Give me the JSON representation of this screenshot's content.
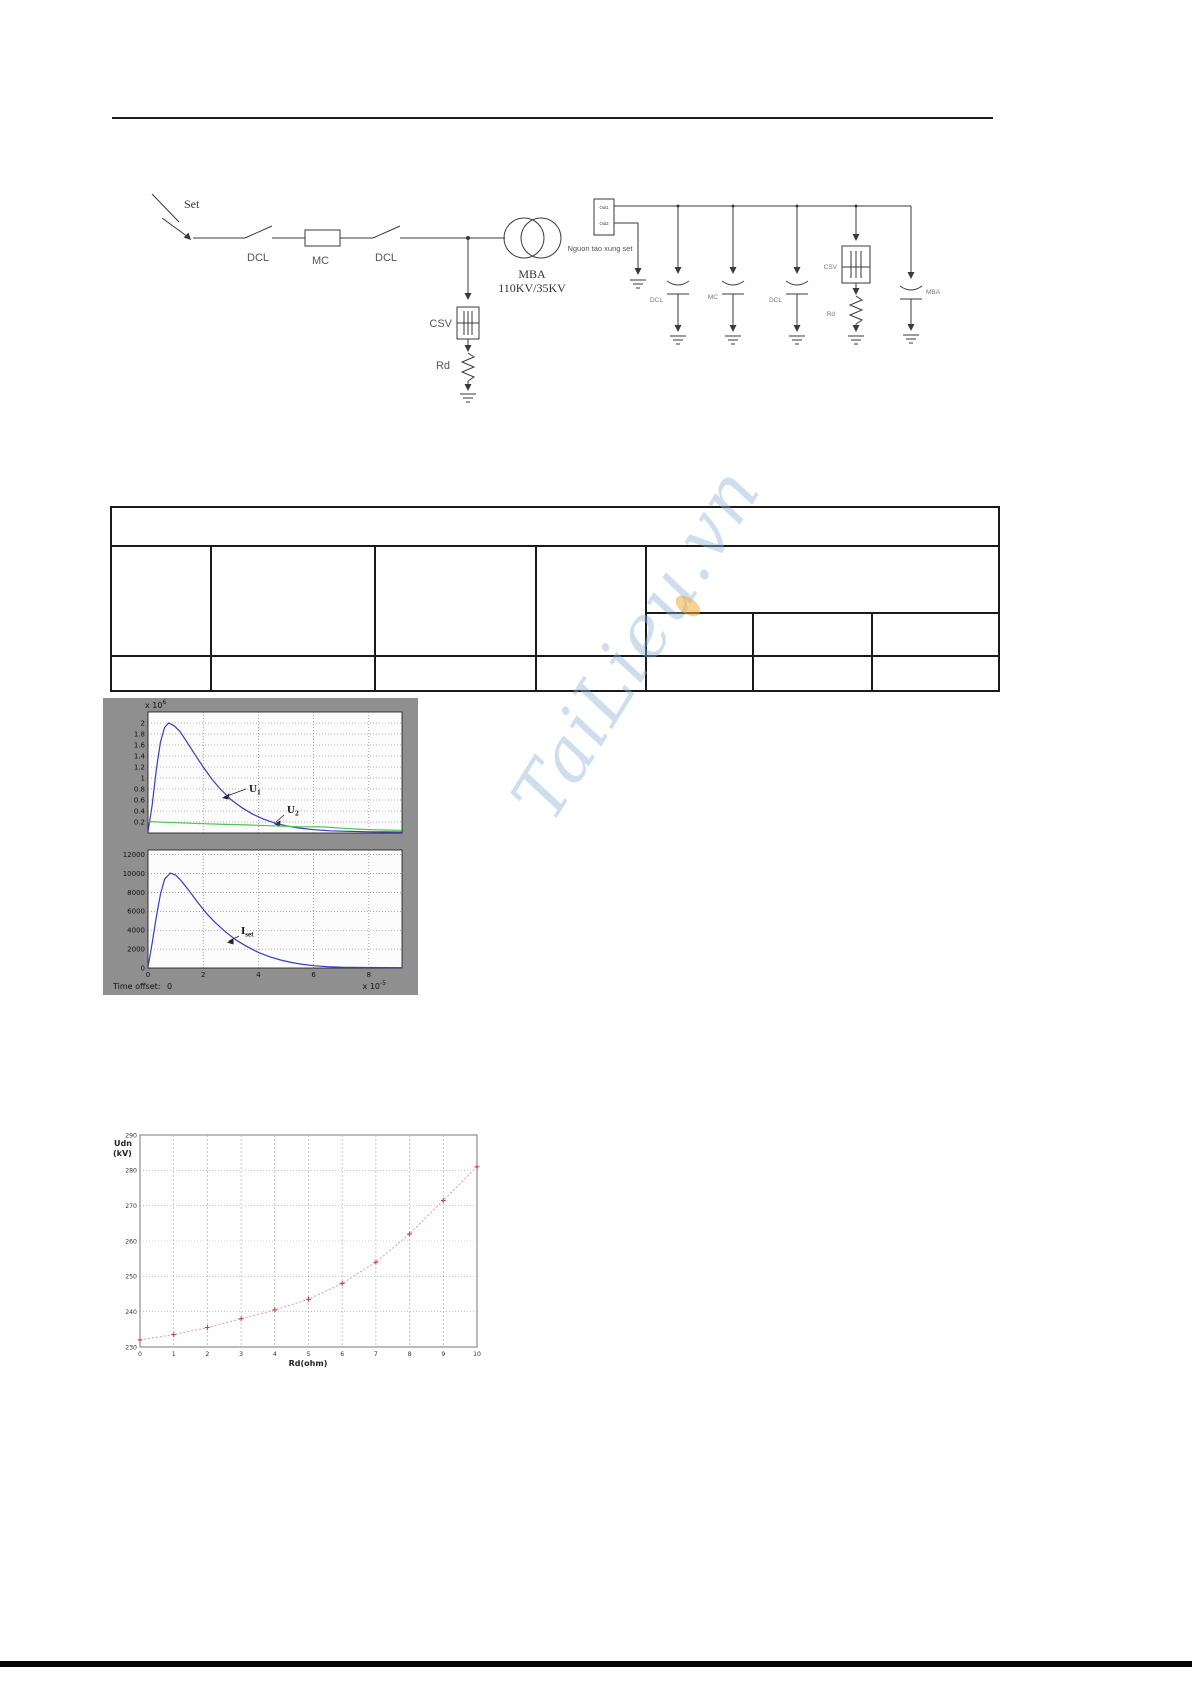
{
  "watermark": {
    "text": "TaiLieu.vn"
  },
  "circuit": {
    "left": {
      "surge_label": "Set",
      "dcl1_label": "DCL",
      "mc_label": "MC",
      "dcl2_label": "DCL",
      "transformer_label": "MBA",
      "transformer_rating": "110KV/35KV",
      "arrester_label": "CSV",
      "resistor_label": "Rd"
    },
    "right": {
      "source_out1": "Out1",
      "source_out2": "Out2",
      "source_label": "Nguon tao xung set",
      "dcl1_label": "DCL",
      "mc_label": "MC",
      "dcl2_label": "DCL",
      "arrester_label": "CSV",
      "resistor_label": "Rd",
      "transformer_label": "MBA"
    }
  },
  "table": {
    "visible_text": []
  },
  "simulation_figure": {
    "top_exp_prefix": "x 10",
    "top_exp": "6",
    "bottom_exp_prefix": "x 10",
    "bottom_exp": "-5",
    "time_offset_label": "Time offset:",
    "time_offset_value": "0",
    "u1_base": "U",
    "u1_sub": "1",
    "u2_base": "U",
    "u2_sub": "2",
    "iset_base": "I",
    "iset_sub": "set"
  },
  "chart_data": [
    {
      "type": "line",
      "y_unit_label": "x 10^6",
      "x_unit_label": "x 10^-5",
      "xlim": [
        0,
        9.2
      ],
      "ylim": [
        0,
        2.2
      ],
      "xticks": [
        0,
        2,
        4,
        6,
        8
      ],
      "yticks": [
        0.2,
        0.4,
        0.6,
        0.8,
        1,
        1.2,
        1.4,
        1.6,
        1.8,
        2
      ],
      "grid": true,
      "annotations": [
        "U1",
        "U2"
      ],
      "series": [
        {
          "name": "U1",
          "color": "#3b3bc4",
          "points": [
            [
              0,
              0.02
            ],
            [
              0.15,
              0.5
            ],
            [
              0.3,
              1.15
            ],
            [
              0.45,
              1.65
            ],
            [
              0.6,
              1.92
            ],
            [
              0.75,
              2.0
            ],
            [
              0.95,
              1.95
            ],
            [
              1.15,
              1.85
            ],
            [
              1.4,
              1.66
            ],
            [
              1.7,
              1.43
            ],
            [
              2.0,
              1.2
            ],
            [
              2.3,
              0.99
            ],
            [
              2.6,
              0.81
            ],
            [
              3.0,
              0.61
            ],
            [
              3.4,
              0.46
            ],
            [
              3.8,
              0.34
            ],
            [
              4.2,
              0.25
            ],
            [
              4.6,
              0.18
            ],
            [
              5.0,
              0.13
            ],
            [
              5.5,
              0.09
            ],
            [
              6.0,
              0.06
            ],
            [
              6.6,
              0.04
            ],
            [
              7.2,
              0.03
            ],
            [
              8.0,
              0.022
            ],
            [
              9.2,
              0.018
            ]
          ]
        },
        {
          "name": "U2",
          "color": "#4fc24f",
          "points": [
            [
              0,
              0.21
            ],
            [
              0.5,
              0.197
            ],
            [
              1.0,
              0.187
            ],
            [
              1.5,
              0.178
            ],
            [
              2.0,
              0.17
            ],
            [
              2.5,
              0.162
            ],
            [
              3.0,
              0.154
            ],
            [
              3.5,
              0.147
            ],
            [
              4.0,
              0.14
            ],
            [
              4.5,
              0.131
            ],
            [
              5.0,
              0.121
            ],
            [
              5.5,
              0.113
            ],
            [
              5.9,
              0.112
            ],
            [
              6.2,
              0.114
            ],
            [
              6.5,
              0.105
            ],
            [
              7.0,
              0.088
            ],
            [
              7.5,
              0.072
            ],
            [
              8.0,
              0.062
            ],
            [
              8.6,
              0.054
            ],
            [
              9.2,
              0.05
            ]
          ]
        }
      ]
    },
    {
      "type": "line",
      "x_unit_label": "x 10^-5",
      "xlim": [
        0,
        9.2
      ],
      "ylim": [
        0,
        12500
      ],
      "xticks": [
        0,
        2,
        4,
        6,
        8
      ],
      "yticks": [
        0,
        2000,
        4000,
        6000,
        8000,
        10000,
        12000
      ],
      "grid": true,
      "annotations": [
        "Iset"
      ],
      "time_offset": "0",
      "series": [
        {
          "name": "Iset",
          "color": "#3b3bc4",
          "points": [
            [
              0,
              100
            ],
            [
              0.15,
              2600
            ],
            [
              0.3,
              5400
            ],
            [
              0.45,
              7800
            ],
            [
              0.6,
              9400
            ],
            [
              0.8,
              10050
            ],
            [
              1.0,
              9850
            ],
            [
              1.2,
              9250
            ],
            [
              1.5,
              8150
            ],
            [
              1.8,
              6950
            ],
            [
              2.1,
              5850
            ],
            [
              2.4,
              4900
            ],
            [
              2.8,
              3850
            ],
            [
              3.2,
              2950
            ],
            [
              3.6,
              2250
            ],
            [
              4.0,
              1650
            ],
            [
              4.4,
              1200
            ],
            [
              4.8,
              850
            ],
            [
              5.2,
              580
            ],
            [
              5.6,
              380
            ],
            [
              6.0,
              240
            ],
            [
              6.5,
              140
            ],
            [
              7.0,
              90
            ],
            [
              7.8,
              55
            ],
            [
              8.6,
              40
            ],
            [
              9.2,
              35
            ]
          ]
        }
      ]
    },
    {
      "type": "line",
      "xlabel": "Rd(ohm)",
      "ylabel": "Udn (kV)",
      "ylabel_lines": [
        "Udn",
        "(kV)"
      ],
      "xlim": [
        0,
        10
      ],
      "ylim": [
        230,
        290
      ],
      "xticks": [
        0,
        1,
        2,
        3,
        4,
        5,
        6,
        7,
        8,
        9,
        10
      ],
      "yticks": [
        230,
        240,
        250,
        260,
        270,
        280,
        290
      ],
      "grid": true,
      "series": [
        {
          "name": "Udn",
          "color": "#e09a9a",
          "marker": "+",
          "line_style": "dotted",
          "x": [
            0,
            1,
            2,
            3,
            4,
            5,
            6,
            7,
            8,
            9,
            10
          ],
          "y": [
            232,
            233.5,
            235.5,
            238,
            240.5,
            243.5,
            248,
            254,
            262,
            271.5,
            281
          ]
        }
      ]
    }
  ]
}
